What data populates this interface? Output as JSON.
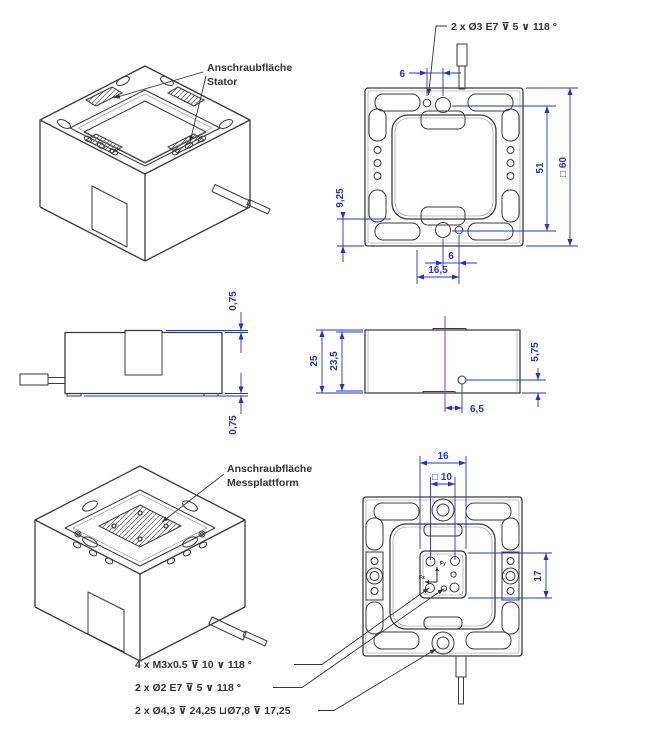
{
  "colors": {
    "background": "#ffffff",
    "drawing_line": "#3a3a3a",
    "dimension_blue": "#2233cc",
    "centerline_magenta": "#a02fa0",
    "text_dark": "#333333"
  },
  "labels": {
    "stator": {
      "line1": "Anschraubfläche",
      "line2": "Stator"
    },
    "messplattform": {
      "line1": "Anschraubfläche",
      "line2": "Messplattform"
    }
  },
  "callouts": {
    "top_holes": "2 x Ø3 E7 ⊽ 5 ∨ 118 °",
    "bottom": [
      "4 x M3x0.5 ⊽ 10 ∨ 118 °",
      "2 x Ø2 E7 ⊽ 5 ∨ 118 °",
      "2 x Ø4,3 ⊽ 24,25 ⊔Ø7,8 ⊽ 17,25"
    ]
  },
  "dimensions": {
    "top_view": {
      "hole_offset_top": "6",
      "inner_height": "51",
      "overall_square": "□ 60",
      "edge_offset": "9,25",
      "hole_offset_bottom": "6",
      "bottom_span": "16,5"
    },
    "side_left_view": {
      "stator_proud_top": "0,75",
      "stator_proud_bottom": "0,75"
    },
    "side_right_view": {
      "overall_height": "25",
      "body_height": "23,5",
      "hole_height": "5,75",
      "hole_offset": "6,5"
    },
    "bottom_view": {
      "plate_width": "16",
      "thread_square": "□ 10",
      "plate_height": "17",
      "axis_y": "Fy",
      "axis_x": "Fx"
    }
  }
}
